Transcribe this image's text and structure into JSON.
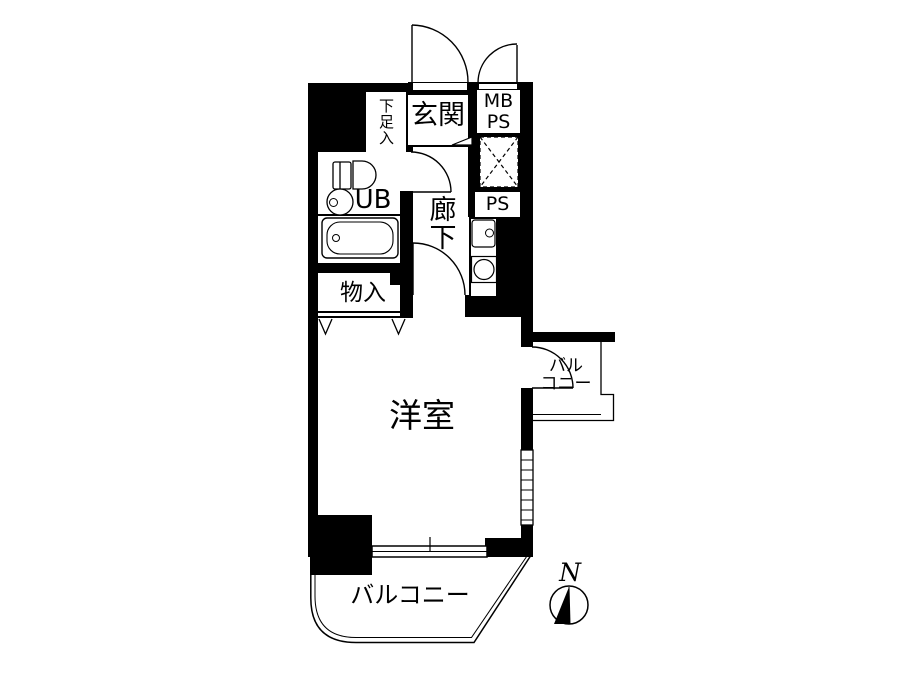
{
  "floorplan": {
    "labels": {
      "genkan": "玄関",
      "shoe_closet": "下足入",
      "meter_box_line1": "MB",
      "meter_box_line2": "PS",
      "unit_bath": "UB",
      "corridor": "廊下",
      "pipe_space": "PS",
      "storage": "物入",
      "western_room": "洋室",
      "side_balcony_line1": "バル",
      "side_balcony_line2": "コニー",
      "balcony": "バルコニー",
      "compass_north": "N"
    },
    "colors": {
      "wall": "#000000",
      "line": "#000000",
      "background": "#ffffff"
    },
    "icons": [
      "door-swing-icon",
      "toilet-icon",
      "washbasin-icon",
      "bathtub-icon",
      "kitchen-sink-icon",
      "stove-burner-icon",
      "shaft-cross-icon",
      "sliding-window-icon",
      "louver-window-icon",
      "closet-chevron-icon",
      "entrance-step-icon",
      "compass-icon"
    ]
  }
}
